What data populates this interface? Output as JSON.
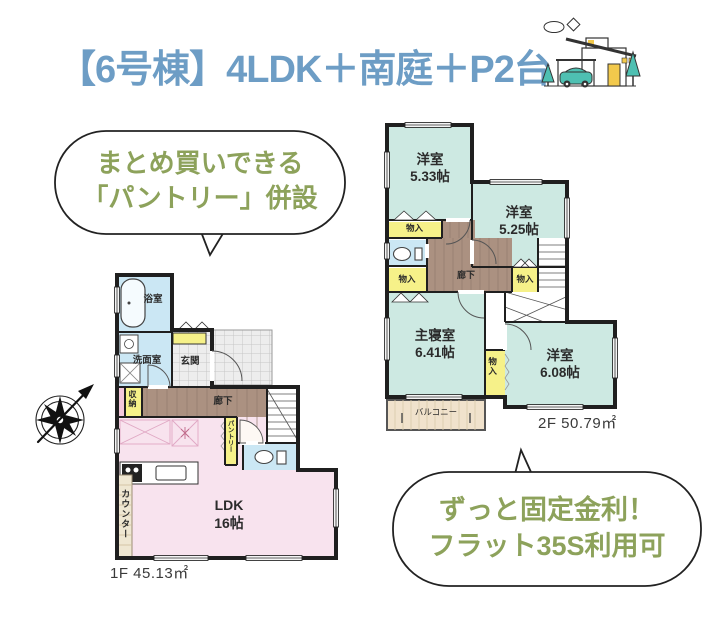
{
  "title": {
    "text": "【6号棟】4LDK＋南庭＋P2台"
  },
  "callouts": {
    "pantry": {
      "line1": "まとめ買いできる",
      "line2": "「パントリー」併設"
    },
    "loan": {
      "line1": "ずっと固定金利！",
      "line2": "フラット35S利用可"
    }
  },
  "floor1": {
    "area_label": "1F 45.13㎡",
    "rooms": {
      "ldk": {
        "name": "LDK",
        "size": "16帖"
      },
      "bathroom": "浴室",
      "washroom": "洗面室",
      "entrance": "玄関",
      "hallway": "廊下",
      "storage": "収納",
      "pantry": "パントリー",
      "counter": "カウンター"
    }
  },
  "floor2": {
    "area_label": "2F 50.79㎡",
    "rooms": {
      "bedroom1": {
        "name": "洋室",
        "size": "5.33帖"
      },
      "bedroom2": {
        "name": "洋室",
        "size": "5.25帖"
      },
      "master": {
        "name": "主寝室",
        "size": "6.41帖"
      },
      "bedroom3": {
        "name": "洋室",
        "size": "6.08帖"
      },
      "hallway": "廊下",
      "closet": "物入",
      "balcony": "バルコニー"
    }
  },
  "colors": {
    "title_blue": "#6d9dc5",
    "callout_green": "#8da25b",
    "room_mint": "#cde9e2",
    "room_pink": "#f8e3ee",
    "water_blue": "#cbe7f4",
    "closet_yellow": "#f6f189",
    "hall_brown": "#ab9181",
    "balcony_beige": "#f0e2cc"
  }
}
